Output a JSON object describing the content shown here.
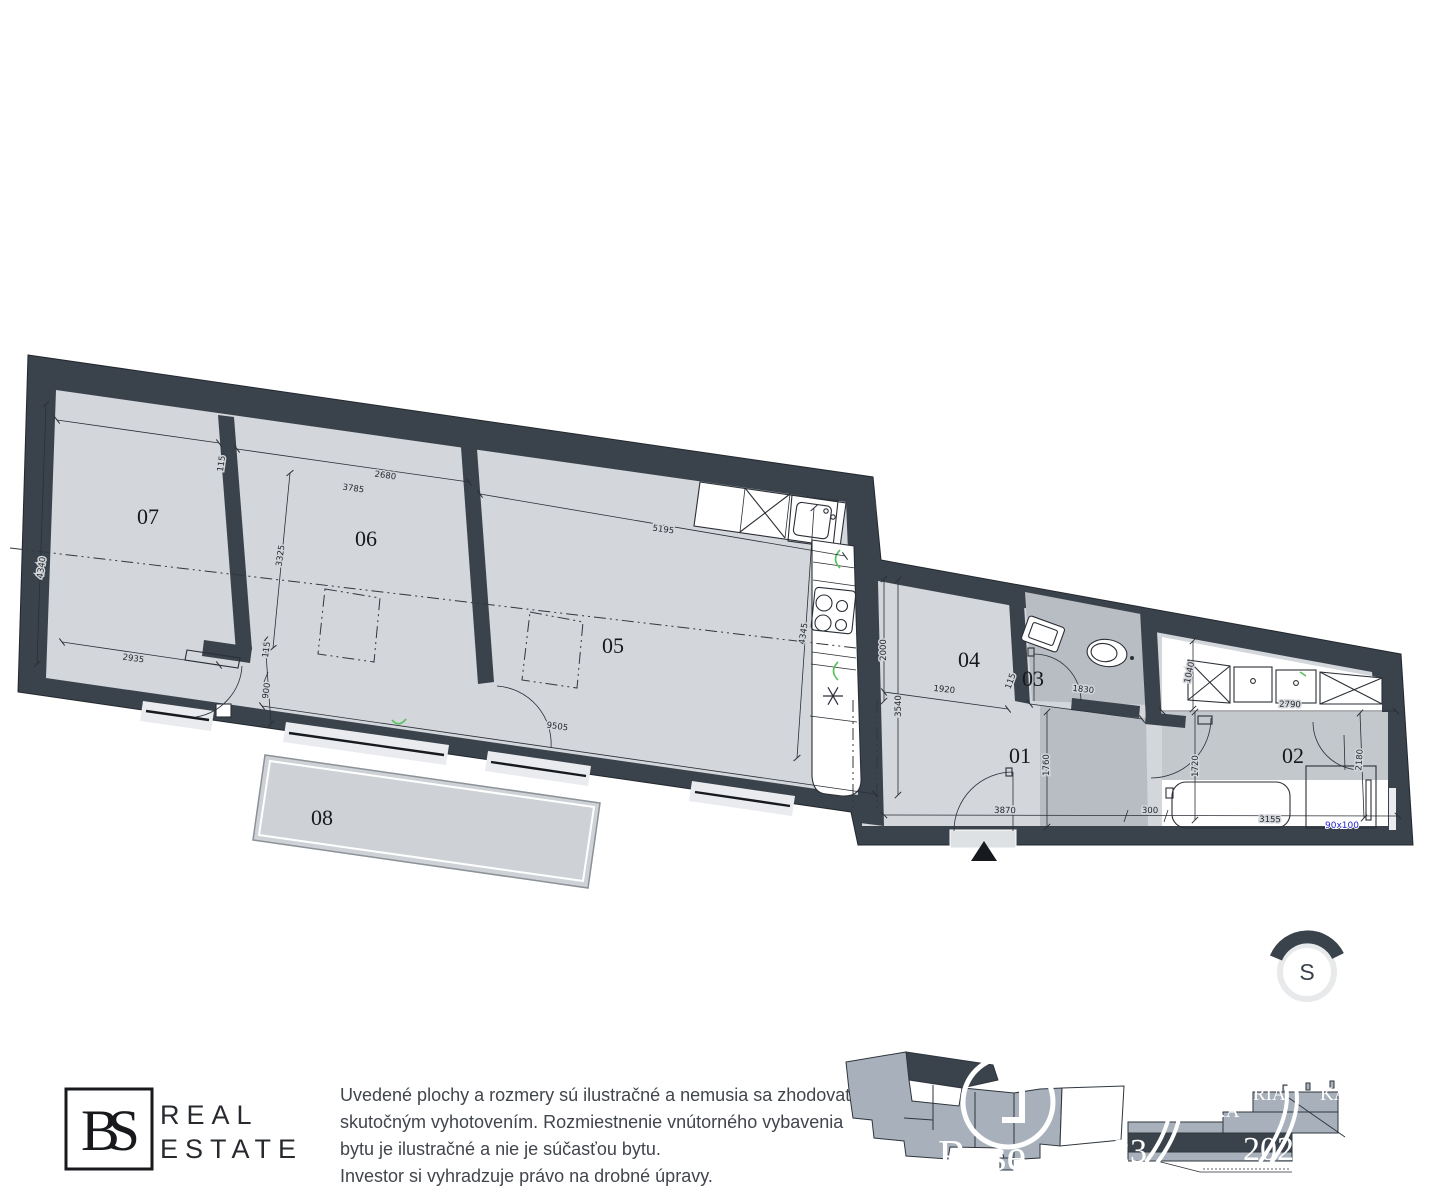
{
  "colors": {
    "wall": "#3a424c",
    "floor_light": "#d3d6da",
    "floor_mid": "#c3c8cd",
    "floor_dark": "#b7bdc3",
    "terrace": "#ced2d6",
    "window": "#e9ebee",
    "entrance": "#dee1e4",
    "green": "#55c05a",
    "blue": "#2323cc",
    "keyplan_gray": "#a8b1bb",
    "north_ring": "#e7e9eb"
  },
  "plan": {
    "rooms": [
      {
        "id": "07",
        "x": 148,
        "y": 524
      },
      {
        "id": "06",
        "x": 366,
        "y": 546
      },
      {
        "id": "05",
        "x": 613,
        "y": 653
      },
      {
        "id": "04",
        "x": 969,
        "y": 667
      },
      {
        "id": "03",
        "x": 1033,
        "y": 686
      },
      {
        "id": "01",
        "x": 1020,
        "y": 763
      },
      {
        "id": "02",
        "x": 1293,
        "y": 763
      },
      {
        "id": "08",
        "x": 322,
        "y": 825
      }
    ],
    "dims": [
      {
        "t": "2680",
        "x": 385,
        "y": 478,
        "r": 8
      },
      {
        "t": "115",
        "x": 224,
        "y": 464,
        "r": -82
      },
      {
        "t": "3785",
        "x": 353,
        "y": 491,
        "r": 8
      },
      {
        "t": "4340",
        "x": 44,
        "y": 568,
        "r": -82
      },
      {
        "t": "3325",
        "x": 283,
        "y": 556,
        "r": -82
      },
      {
        "t": "5195",
        "x": 663,
        "y": 532,
        "r": 8
      },
      {
        "t": "2935",
        "x": 133,
        "y": 661,
        "r": 8
      },
      {
        "t": "115",
        "x": 269,
        "y": 650,
        "r": -82
      },
      {
        "t": "900",
        "x": 269,
        "y": 691,
        "r": -82
      },
      {
        "t": "9505",
        "x": 557,
        "y": 729,
        "r": 8
      },
      {
        "t": "4345",
        "x": 806,
        "y": 634,
        "r": -82
      },
      {
        "t": "2000",
        "x": 886,
        "y": 650,
        "r": -90
      },
      {
        "t": "3540",
        "x": 901,
        "y": 706,
        "r": -90
      },
      {
        "t": "1920",
        "x": 944,
        "y": 692,
        "r": 6
      },
      {
        "t": "115",
        "x": 1013,
        "y": 682,
        "r": -70
      },
      {
        "t": "1830",
        "x": 1083,
        "y": 692,
        "r": 6
      },
      {
        "t": "1760",
        "x": 1049,
        "y": 765,
        "r": -90
      },
      {
        "t": "3870",
        "x": 1005,
        "y": 813,
        "r": 1
      },
      {
        "t": "300",
        "x": 1150,
        "y": 813,
        "r": 1
      },
      {
        "t": "1040",
        "x": 1192,
        "y": 673,
        "r": -78
      },
      {
        "t": "2790",
        "x": 1290,
        "y": 707,
        "r": 1
      },
      {
        "t": "1720",
        "x": 1198,
        "y": 766,
        "r": -90
      },
      {
        "t": "2180",
        "x": 1362,
        "y": 760,
        "r": -86
      },
      {
        "t": "3155",
        "x": 1270,
        "y": 822,
        "r": 1
      }
    ],
    "shower_label": {
      "t": "90x100"
    }
  },
  "north": {
    "label": "S"
  },
  "logo": {
    "monogram": "BS",
    "line1": "REAL",
    "line2": "ESTATE"
  },
  "disclaimer": {
    "lines": [
      "Uvedené plochy a rozmery sú ilustračné a nemusia sa zhodovať so",
      "skutočným vyhotovením. Rozmiestnenie vnútorného vybavenia",
      "bytu je ilustračné a nie je súčasťou bytu.",
      "Investor si vyhradzuje právo na drobné úpravy."
    ]
  },
  "watermarks": {
    "keyplan_text": "Rose",
    "keyplan_sub": "ESTATE",
    "fragments": [
      {
        "t": "RIA",
        "x": 1253,
        "y": 1100,
        "s": 19
      },
      {
        "t": "KA",
        "x": 1212,
        "y": 1117,
        "s": 19
      },
      {
        "t": "KA",
        "x": 1320,
        "y": 1100,
        "s": 19
      },
      {
        "t": "23",
        "x": 1113,
        "y": 1162,
        "s": 34
      },
      {
        "t": "2020",
        "x": 1243,
        "y": 1160,
        "s": 34
      }
    ]
  }
}
